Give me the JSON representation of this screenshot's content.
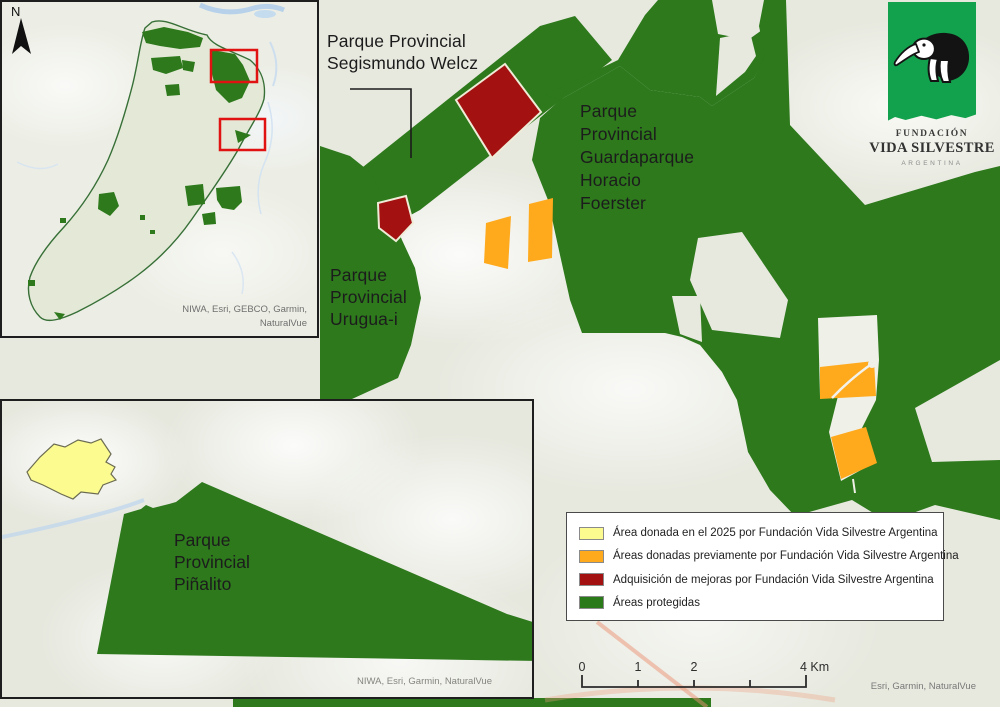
{
  "map": {
    "labels": {
      "welcz": {
        "lines": [
          "Parque Provincial",
          "Segismundo Welcz"
        ]
      },
      "foerster": {
        "lines": [
          "Parque",
          "Provincial",
          "Guardaparque",
          "Horacio",
          "Foerster"
        ]
      },
      "uruguai": {
        "lines": [
          "Parque",
          "Provincial",
          "Urugua-i"
        ]
      },
      "pinalito": {
        "lines": [
          "Parque",
          "Provincial",
          "Piñalito"
        ]
      }
    },
    "north_label": "N",
    "attribution_main": "Esri, Garmin, NaturalVue",
    "attribution_overview_inset": {
      "line1": "NIWA, Esri, GEBCO, Garmin,",
      "line2": "NaturalVue"
    },
    "attribution_pinalito_inset": "NIWA, Esri, Garmin, NaturalVue"
  },
  "legend": {
    "items": [
      {
        "label": "Área donada en el 2025 por Fundación Vida Silvestre Argentina",
        "color": "#FBFB8F"
      },
      {
        "label": "Áreas donadas previamente por Fundación Vida Silvestre Argentina",
        "color": "#FFA91C"
      },
      {
        "label": "Adquisición de mejoras por Fundación Vida Silvestre Argentina",
        "color": "#A31111"
      },
      {
        "label": "Áreas protegidas",
        "color": "#2B7A1A"
      }
    ]
  },
  "scalebar": {
    "labels": [
      "0",
      "1",
      "2",
      "4 Km"
    ]
  },
  "logo": {
    "line1": "FUNDACIÓN",
    "line2": "VIDA SILVESTRE",
    "line3": "ARGENTINA"
  },
  "colors": {
    "protected_green": "#2D791C",
    "donated_2025_yellow": "#FBFB8F",
    "donated_previous_orange": "#FFA91C",
    "mejoras_red": "#A31111",
    "overview_highlight_red": "#E01212"
  }
}
